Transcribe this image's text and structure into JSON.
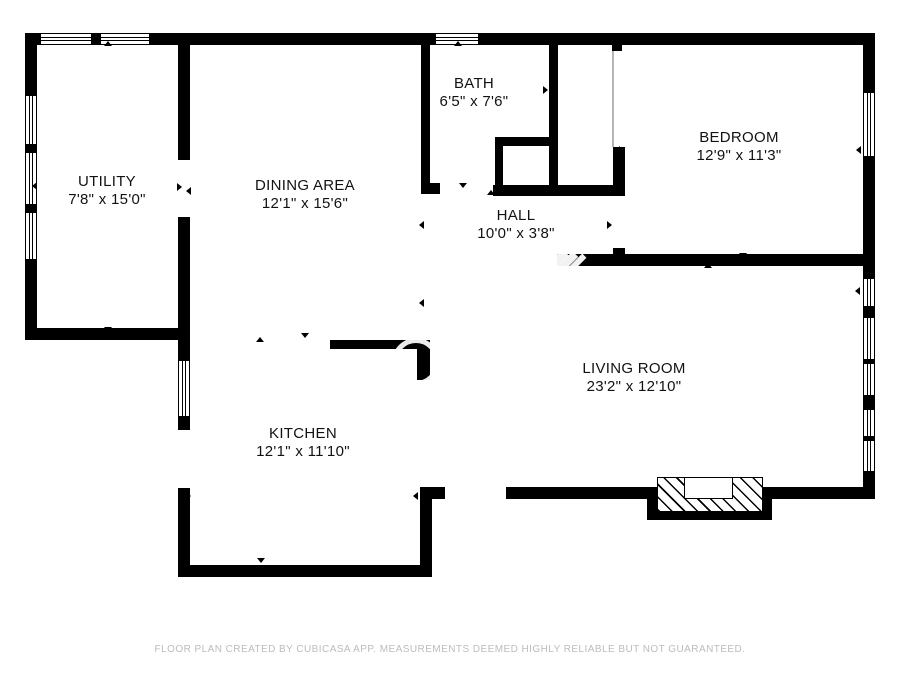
{
  "page": {
    "background": "#ffffff",
    "wall_color": "#000000",
    "label_color": "#121212",
    "footer_color": "#bcbcbc",
    "app_name": "CUBICASA"
  },
  "rooms": [
    {
      "id": "utility",
      "name": "UTILITY",
      "dims": "7'8\" x 15'0\"",
      "cx": 107,
      "cy": 191
    },
    {
      "id": "dining-area",
      "name": "DINING AREA",
      "dims": "12'1\" x 15'6\"",
      "cx": 305,
      "cy": 195
    },
    {
      "id": "bath",
      "name": "BATH",
      "dims": "6'5\" x 7'6\"",
      "cx": 474,
      "cy": 93
    },
    {
      "id": "hall",
      "name": "HALL",
      "dims": "10'0\" x 3'8\"",
      "cx": 516,
      "cy": 225
    },
    {
      "id": "bedroom",
      "name": "BEDROOM",
      "dims": "12'9\" x 11'3\"",
      "cx": 739,
      "cy": 147
    },
    {
      "id": "living-room",
      "name": "LIVING ROOM",
      "dims": "23'2\" x 12'10\"",
      "cx": 634,
      "cy": 378
    },
    {
      "id": "kitchen",
      "name": "KITCHEN",
      "dims": "12'1\" x 11'10\"",
      "cx": 303,
      "cy": 443
    }
  ],
  "footer": {
    "text": "FLOOR PLAN CREATED BY CUBICASA APP. MEASUREMENTS DEEMED HIGHLY RELIABLE BUT NOT GUARANTEED."
  },
  "geometry": {
    "walls": [
      [
        25,
        33,
        850,
        12
      ],
      [
        25,
        33,
        12,
        307
      ],
      [
        25,
        328,
        165,
        12
      ],
      [
        178,
        42,
        12,
        118
      ],
      [
        178,
        217,
        12,
        123
      ],
      [
        178,
        340,
        12,
        237
      ],
      [
        178,
        565,
        254,
        12
      ],
      [
        420,
        487,
        12,
        90
      ],
      [
        420,
        487,
        25,
        12
      ],
      [
        417,
        340,
        13,
        40
      ],
      [
        330,
        340,
        97,
        9
      ],
      [
        421,
        42,
        9,
        141
      ],
      [
        421,
        183,
        19,
        11
      ],
      [
        493,
        185,
        132,
        11
      ],
      [
        549,
        42,
        9,
        154
      ],
      [
        495,
        137,
        57,
        9
      ],
      [
        495,
        137,
        8,
        50
      ],
      [
        612,
        42,
        10,
        9
      ],
      [
        613,
        147,
        12,
        49
      ],
      [
        613,
        248,
        12,
        18
      ],
      [
        557,
        254,
        318,
        12
      ],
      [
        506,
        487,
        369,
        12
      ],
      [
        863,
        33,
        12,
        466
      ],
      [
        647,
        487,
        125,
        33
      ]
    ],
    "gaps": [
      [
        178,
        430,
        12,
        58
      ]
    ],
    "windows": [
      [
        40,
        33,
        52,
        12,
        "h"
      ],
      [
        100,
        33,
        50,
        12,
        "h"
      ],
      [
        435,
        33,
        44,
        12,
        "h"
      ],
      [
        25,
        95,
        12,
        50,
        "v"
      ],
      [
        25,
        152,
        12,
        53,
        "v"
      ],
      [
        25,
        212,
        12,
        48,
        "v"
      ],
      [
        178,
        360,
        12,
        57,
        "v"
      ],
      [
        863,
        92,
        12,
        65,
        "v"
      ],
      [
        863,
        278,
        12,
        29,
        "v"
      ],
      [
        863,
        317,
        12,
        43,
        "v"
      ],
      [
        863,
        363,
        12,
        33,
        "v"
      ],
      [
        863,
        409,
        12,
        28,
        "v"
      ],
      [
        863,
        440,
        12,
        32,
        "v"
      ]
    ],
    "fireplace": {
      "hatch": [
        657,
        477,
        106,
        35
      ],
      "inner": [
        684,
        477,
        49,
        22
      ]
    },
    "closet_opening_line": [
      612,
      51,
      2,
      96
    ],
    "door_markers": [
      {
        "x": 108,
        "y": 45,
        "dir": "up"
      },
      {
        "x": 36,
        "y": 186,
        "dir": "left"
      },
      {
        "x": 181,
        "y": 187,
        "dir": "right"
      },
      {
        "x": 190,
        "y": 191,
        "dir": "left"
      },
      {
        "x": 108,
        "y": 331,
        "dir": "down"
      },
      {
        "x": 458,
        "y": 45,
        "dir": "up"
      },
      {
        "x": 428,
        "y": 90,
        "dir": "left"
      },
      {
        "x": 547,
        "y": 90,
        "dir": "right"
      },
      {
        "x": 463,
        "y": 187,
        "dir": "down"
      },
      {
        "x": 491,
        "y": 194,
        "dir": "up"
      },
      {
        "x": 511,
        "y": 190,
        "dir": "down"
      },
      {
        "x": 623,
        "y": 150,
        "dir": "right"
      },
      {
        "x": 611,
        "y": 225,
        "dir": "right"
      },
      {
        "x": 743,
        "y": 44,
        "dir": "up"
      },
      {
        "x": 743,
        "y": 257,
        "dir": "down"
      },
      {
        "x": 708,
        "y": 267,
        "dir": "up"
      },
      {
        "x": 860,
        "y": 150,
        "dir": "left"
      },
      {
        "x": 859,
        "y": 291,
        "dir": "left"
      },
      {
        "x": 423,
        "y": 225,
        "dir": "left"
      },
      {
        "x": 423,
        "y": 303,
        "dir": "left"
      },
      {
        "x": 260,
        "y": 341,
        "dir": "up"
      },
      {
        "x": 305,
        "y": 337,
        "dir": "down"
      },
      {
        "x": 261,
        "y": 562,
        "dir": "down"
      },
      {
        "x": 190,
        "y": 496,
        "dir": "right"
      },
      {
        "x": 417,
        "y": 496,
        "dir": "left"
      }
    ],
    "watermark": {
      "ring": {
        "cx": 411,
        "cy": 357,
        "r": 19
      },
      "slashes": [
        [
          553,
          249,
          9,
          23
        ],
        [
          564,
          251,
          8,
          21
        ],
        [
          575,
          253,
          6,
          18
        ]
      ],
      "smudges": [
        [
          286,
          427,
          48,
          5
        ],
        [
          295,
          446,
          38,
          4
        ]
      ]
    }
  }
}
